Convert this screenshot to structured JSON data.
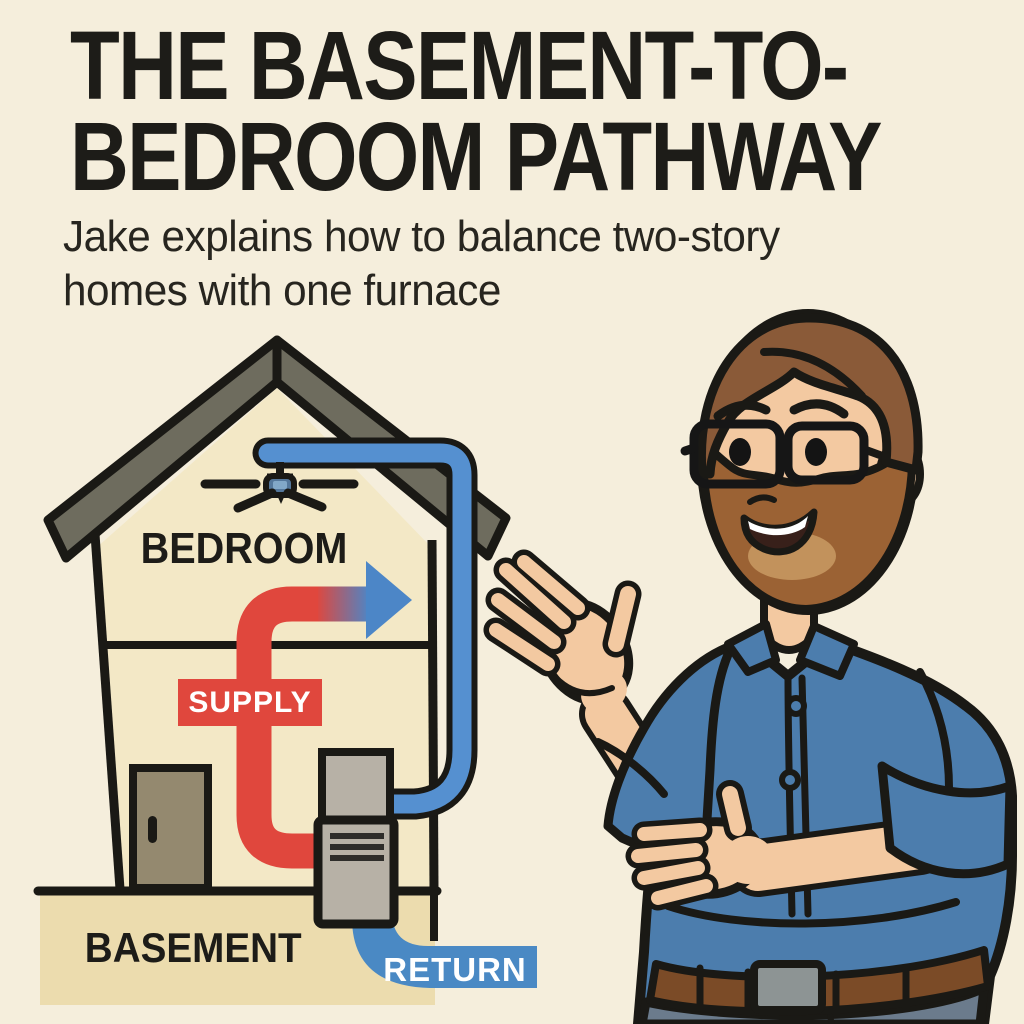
{
  "header": {
    "title_line1": "THE BASEMENT-TO-",
    "title_line2": "BEDROOM PATHWAY",
    "subtitle_line1": "Jake explains how to balance two-story",
    "subtitle_line2": "homes with one furnace"
  },
  "diagram": {
    "bedroom_label": "BEDROOM",
    "supply_label": "SUPPLY",
    "basement_label": "BASEMENT",
    "return_label": "RETURN",
    "icons": [
      "house-icon",
      "roof-icon",
      "ceiling-fan-icon",
      "door-icon",
      "furnace-icon",
      "supply-arrow-icon",
      "return-pipe-icon",
      "presenter-icon"
    ]
  },
  "colors": {
    "background": "#F5EEDC",
    "house_wall": "#F3E8C6",
    "roof_gray": "#6E6C5E",
    "supply_red": "#E0473D",
    "pipe_blue": "#5590D0",
    "arrow_blue": "#4C86C7",
    "return_badge_blue": "#4A89C4",
    "furnace_gray": "#B7B1A6",
    "furnace_vent_dark": "#2E2D2A",
    "ground_tan": "#ECDCAE",
    "door_tan": "#94896F",
    "outline_black": "#1A1915",
    "skin": "#F3C9A1",
    "hair_brown": "#8A5A38",
    "beard_brown": "#9B6234",
    "beard_light": "#C2925C",
    "shirt_blue": "#4C7DAD",
    "pants_gray": "#6B7B8C",
    "belt_brown": "#7B4B27",
    "buckle_gray": "#8D9494",
    "text_dark": "#1D1C18"
  }
}
